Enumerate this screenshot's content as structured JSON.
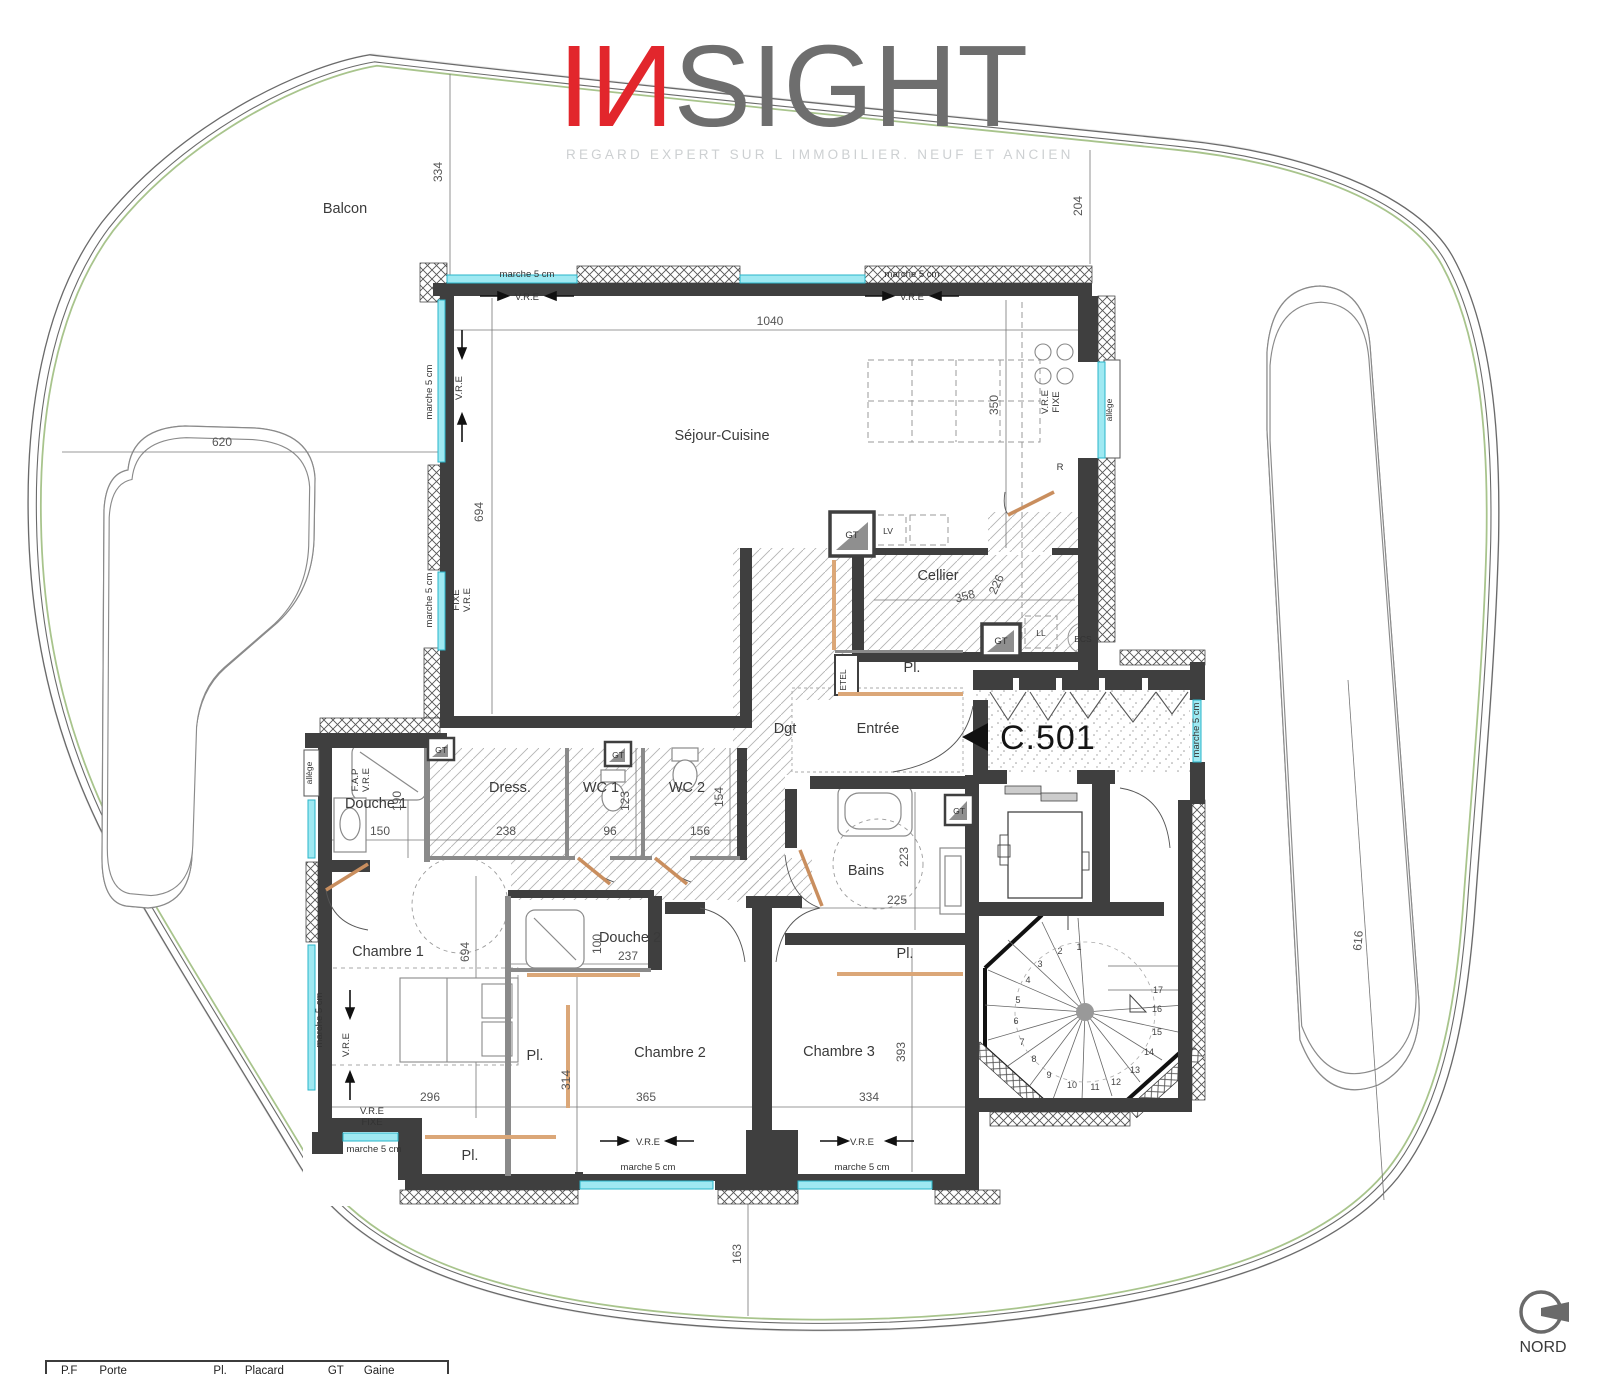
{
  "logo": {
    "part1": "I",
    "part2": "И",
    "part3": "SIGHT",
    "tagline": "REGARD EXPERT SUR L IMMOBILIER. NEUF ET ANCIEN"
  },
  "unit": {
    "id": "C.501"
  },
  "compass": {
    "label": "NORD"
  },
  "terrace": {
    "balcony": "Balcon"
  },
  "rooms": {
    "sejour": "Séjour-Cuisine",
    "cellier": "Cellier",
    "entree": "Entrée",
    "degagement": "Dgt",
    "dressing": "Dress.",
    "wc1": "WC 1",
    "wc2": "WC 2",
    "douche1": "Douche 1",
    "douche2": "Douche 2",
    "bains": "Bains",
    "chambre1": "Chambre 1",
    "chambre2": "Chambre 2",
    "chambre3": "Chambre 3",
    "placard": "Pl."
  },
  "annotations": {
    "vre": "V.R.E",
    "fixe": "FIXE",
    "fap": "F.A.P",
    "marche": "marche 5 cm",
    "allege": "allège",
    "etel": "ETEL",
    "gt": "GT",
    "lv": "LV",
    "ll": "LL",
    "ecs": "ECS",
    "refrigerator": "R"
  },
  "dimensions": {
    "d334_top": "334",
    "d204": "204",
    "d1040": "1040",
    "d694_sejour": "694",
    "d350": "350",
    "d620": "620",
    "d616": "616",
    "d358": "358",
    "d226": "226",
    "d150": "150",
    "d190": "190",
    "d238": "238",
    "d96": "96",
    "d123": "123",
    "d156": "156",
    "d154": "154",
    "d237": "237",
    "d100": "100",
    "d223": "223",
    "d225": "225",
    "d694_ch1": "694",
    "d296": "296",
    "d314": "314",
    "d365": "365",
    "d334_ch3": "334",
    "d393": "393",
    "d163": "163"
  },
  "stair": {
    "steps": [
      "1",
      "2",
      "3",
      "4",
      "5",
      "6",
      "7",
      "8",
      "9",
      "10",
      "11",
      "12",
      "13",
      "14",
      "15",
      "16",
      "17"
    ]
  },
  "legend": {
    "items": [
      {
        "abbr": "P.F",
        "label": "Porte fenêtre"
      },
      {
        "abbr": "Pl.",
        "label": "Placard"
      },
      {
        "abbr": "GT",
        "label": "Gaine technique"
      }
    ]
  },
  "colors": {
    "accent_red": "#e2262c",
    "window_cyan": "#63d9e8",
    "wood_tan": "#c98e5e",
    "plant_green": "#96a94e",
    "wall_dark": "#3f3f3f"
  }
}
